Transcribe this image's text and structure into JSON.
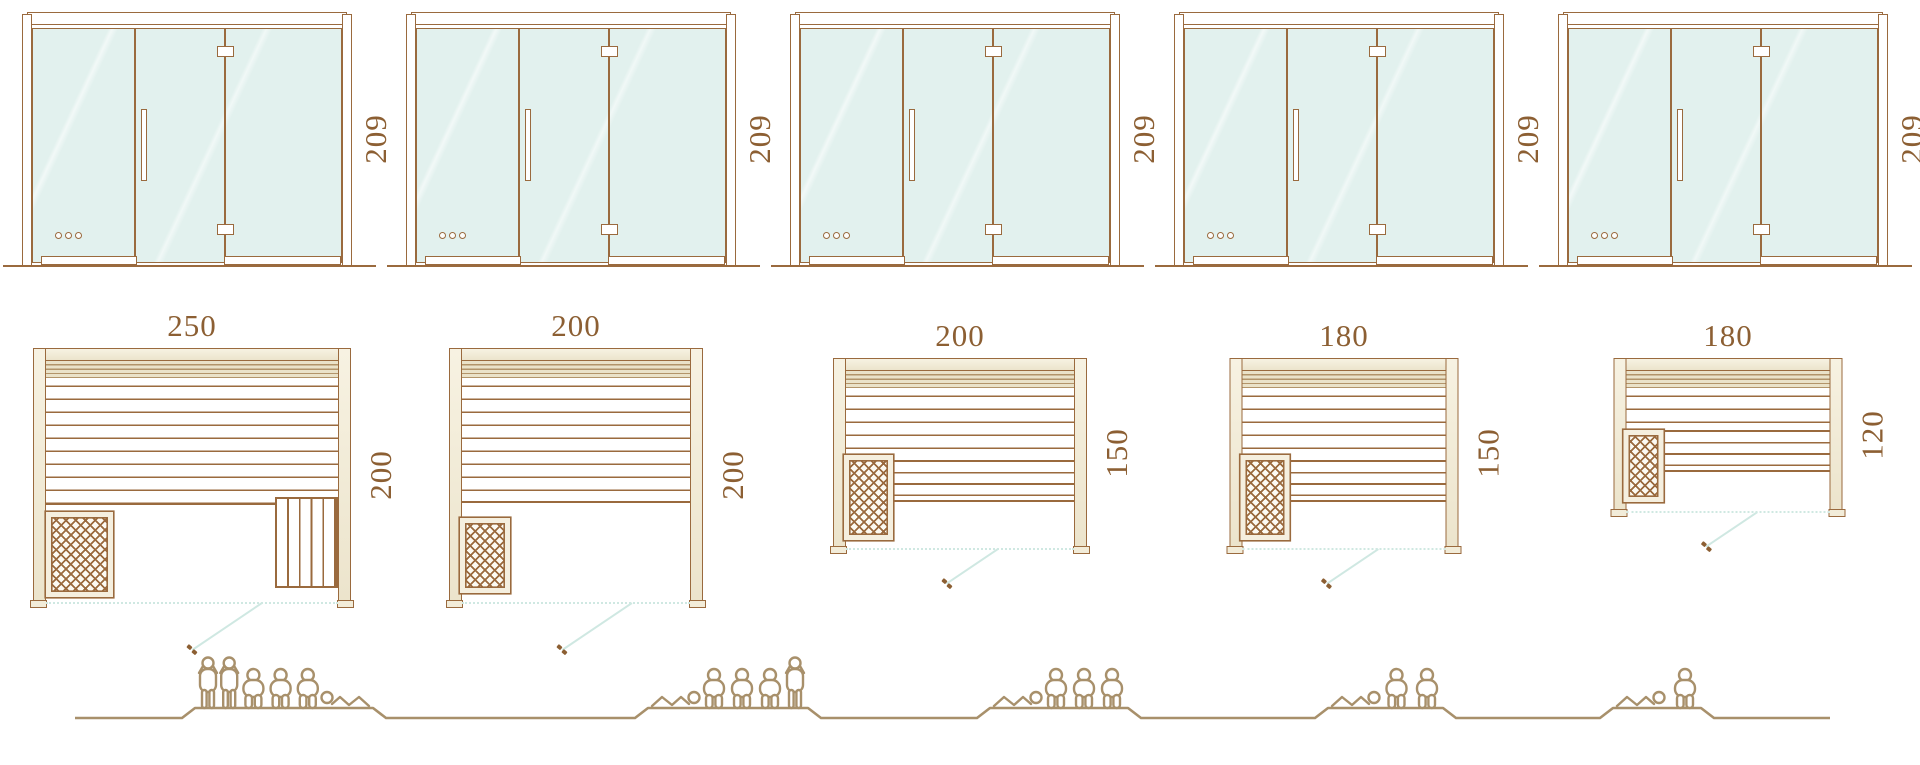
{
  "diagram_title": "sauna-size-range-diagram",
  "colors": {
    "line_brown": "#9a6a3e",
    "dimension_text": "#8c5f33",
    "glass_fill": "#e2f1ee",
    "wall_beige": "#f2ecd9",
    "door_swing_teal": "#cfe8e2",
    "people_line": "#a8906b",
    "background": "#ffffff"
  },
  "models": [
    {
      "name": "sauna-250x200",
      "door_height_label": "209",
      "width_label": "250",
      "depth_label": "200",
      "capacity": 6,
      "layout": {
        "plan_w": 318,
        "plan_h": 254,
        "plan_top": 348,
        "bench_bottom": 157,
        "heater": {
          "x": 13,
          "y": 164,
          "w": 67,
          "h": 85
        },
        "right_bench": {
          "x": 242,
          "y": 149,
          "w": 63,
          "h": 91
        },
        "low_bench": null,
        "door_swing_len": 84,
        "door_swing_x_pct": 72
      }
    },
    {
      "name": "sauna-200x200",
      "door_height_label": "209",
      "width_label": "200",
      "depth_label": "200",
      "capacity": 5,
      "layout": {
        "plan_w": 254,
        "plan_h": 254,
        "plan_top": 348,
        "bench_bottom": 155,
        "heater": {
          "x": 11,
          "y": 170,
          "w": 50,
          "h": 75
        },
        "right_bench": null,
        "low_bench": null,
        "door_swing_len": 84,
        "door_swing_x_pct": 72
      }
    },
    {
      "name": "sauna-200x150",
      "door_height_label": "209",
      "width_label": "200",
      "depth_label": "150",
      "capacity": 4,
      "layout": {
        "plan_w": 254,
        "plan_h": 190,
        "plan_top": 358,
        "bench_bottom": 104,
        "heater": {
          "x": 11,
          "y": 97,
          "w": 49,
          "h": 85
        },
        "right_bench": null,
        "low_bench": {
          "x": 60,
          "y": 104,
          "w": 181,
          "h": 40
        },
        "door_swing_len": 62,
        "door_swing_x_pct": 65
      }
    },
    {
      "name": "sauna-180x150",
      "door_height_label": "209",
      "width_label": "180",
      "depth_label": "150",
      "capacity": 3,
      "layout": {
        "plan_w": 229,
        "plan_h": 190,
        "plan_top": 358,
        "bench_bottom": 104,
        "heater": {
          "x": 11,
          "y": 97,
          "w": 49,
          "h": 85
        },
        "right_bench": null,
        "low_bench": {
          "x": 60,
          "y": 104,
          "w": 156,
          "h": 40
        },
        "door_swing_len": 62,
        "door_swing_x_pct": 65
      }
    },
    {
      "name": "sauna-180x120",
      "door_height_label": "209",
      "width_label": "180",
      "depth_label": "120",
      "capacity": 2,
      "layout": {
        "plan_w": 229,
        "plan_h": 153,
        "plan_top": 358,
        "bench_bottom": 74,
        "heater": {
          "x": 10,
          "y": 72,
          "w": 40,
          "h": 72
        },
        "right_bench": null,
        "low_bench": {
          "x": 50,
          "y": 74,
          "w": 166,
          "h": 40
        },
        "door_swing_len": 62,
        "door_swing_x_pct": 63
      }
    }
  ],
  "capacity_row": {
    "line": {
      "start": 75,
      "end": 1830,
      "y": 73,
      "plateau_y": 63,
      "ramp": 13
    },
    "groups": [
      {
        "x": 195,
        "w": 178,
        "figures": [
          "standing",
          "standing",
          "sitting",
          "sitting",
          "sitting",
          "recline_right"
        ]
      },
      {
        "x": 648,
        "w": 160,
        "figures": [
          "recline_left",
          "sitting",
          "sitting",
          "sitting",
          "standing"
        ]
      },
      {
        "x": 990,
        "w": 138,
        "figures": [
          "recline_left",
          "sitting",
          "sitting",
          "sitting"
        ]
      },
      {
        "x": 1328,
        "w": 115,
        "figures": [
          "recline_left",
          "sitting",
          "sitting"
        ]
      },
      {
        "x": 1613,
        "w": 88,
        "figures": [
          "recline_left",
          "sitting"
        ]
      }
    ]
  }
}
